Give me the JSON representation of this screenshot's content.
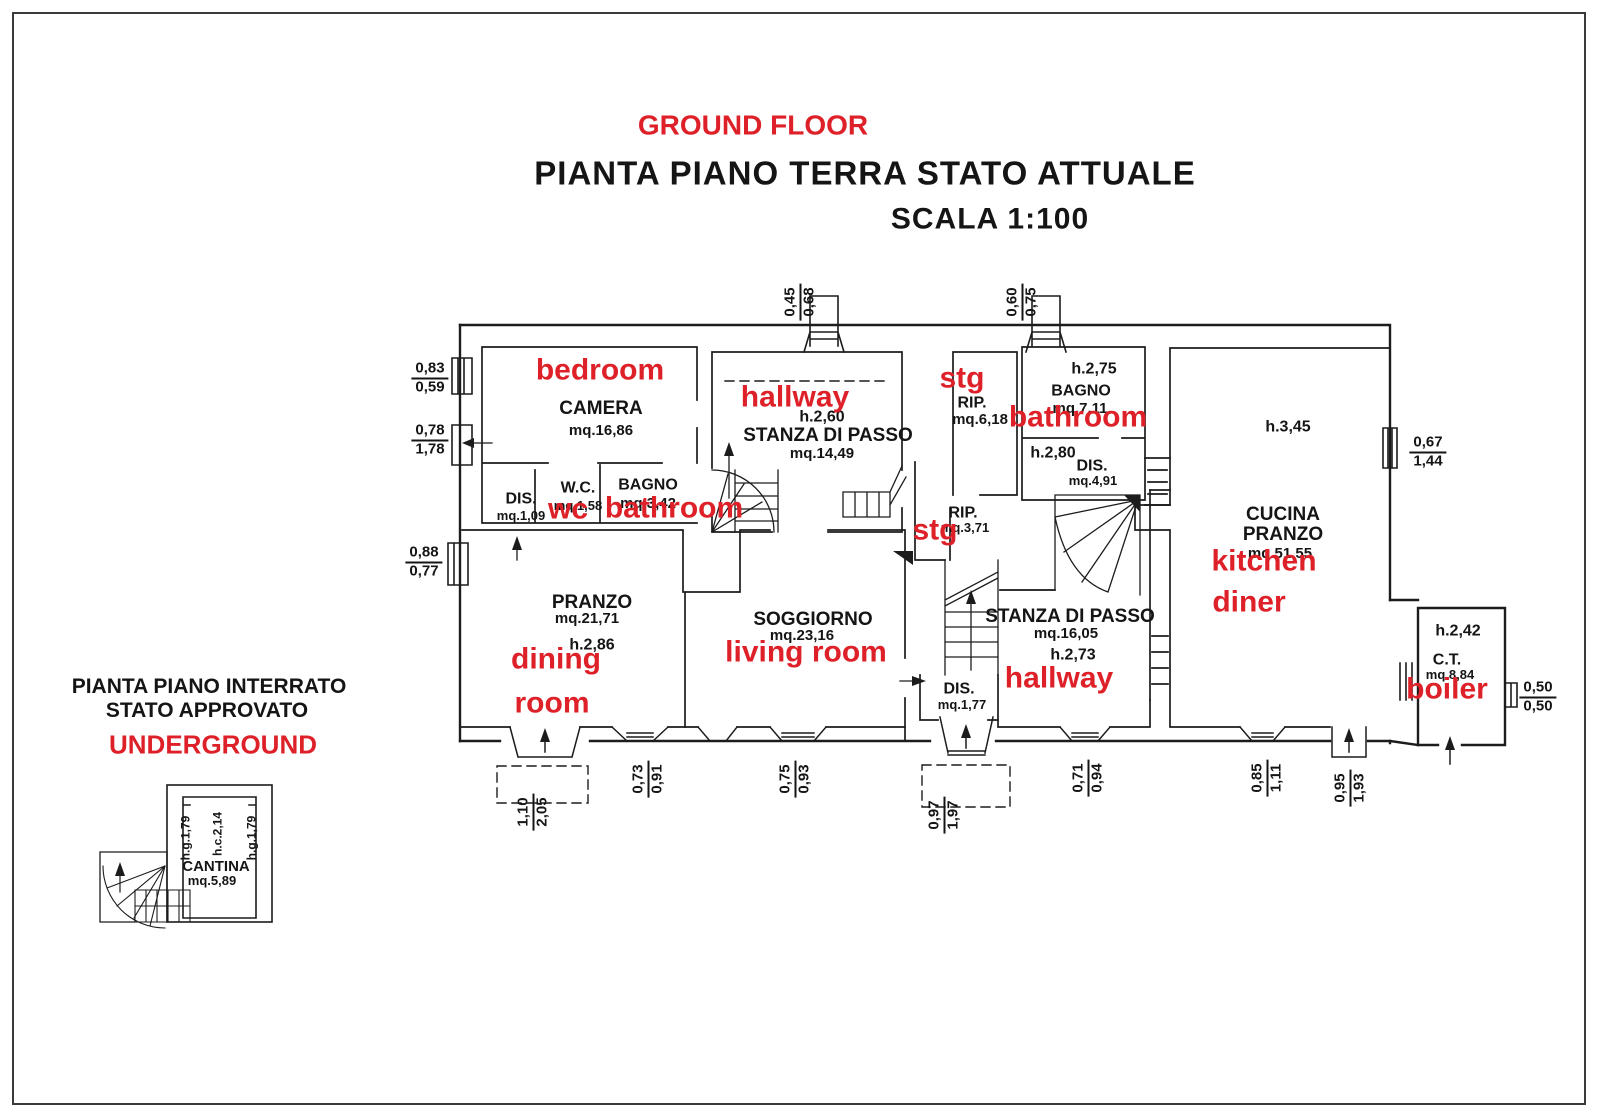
{
  "header": {
    "annotation": "GROUND FLOOR",
    "title": "PIANTA PIANO TERRA STATO ATTUALE",
    "scale": "SCALA 1:100"
  },
  "underground": {
    "title1": "PIANTA PIANO INTERRATO",
    "title2": "STATO APPROVATO",
    "annotation": "UNDERGROUND",
    "cantina": {
      "name": "CANTINA",
      "area": "mq.5,89"
    },
    "heights": {
      "left": "h.g.1,79",
      "center": "h.c.2,14",
      "right": "h.g.1,79"
    }
  },
  "rooms": {
    "camera": {
      "name": "CAMERA",
      "area": "mq.16,86"
    },
    "wc": {
      "name": "W.C.",
      "area": "mq.1,58"
    },
    "bagno1": {
      "name": "BAGNO",
      "area": "mq.3,42"
    },
    "dis1": {
      "name": "DIS.",
      "area": "mq.1,09"
    },
    "stanza1": {
      "name": "STANZA DI PASSO",
      "area": "mq.14,49",
      "height": "h.2,60"
    },
    "rip1": {
      "name": "RIP.",
      "area": "mq.6,18"
    },
    "bagno2": {
      "name": "BAGNO",
      "area": "mq.7,11",
      "height": "h.2,75"
    },
    "dis2": {
      "name": "DIS.",
      "area": "mq.4,91",
      "height": "h.2,80"
    },
    "rip2": {
      "name": "RIP.",
      "area": "mq.3,71"
    },
    "pranzo": {
      "name": "PRANZO",
      "area": "mq.21,71",
      "height": "h.2,86"
    },
    "soggiorno": {
      "name": "SOGGIORNO",
      "area": "mq.23,16"
    },
    "stanza2": {
      "name": "STANZA DI PASSO",
      "area": "mq.16,05",
      "height": "h.2,73"
    },
    "dis3": {
      "name": "DIS.",
      "area": "mq.1,77"
    },
    "cucina": {
      "name1": "CUCINA",
      "name2": "PRANZO",
      "area": "mq.51,55",
      "height": "h.3,45"
    },
    "ct": {
      "name": "C.T.",
      "area": "mq.8,84",
      "height": "h.2,42"
    }
  },
  "annotations": {
    "bedroom": "bedroom",
    "wc": "wc",
    "bathroom1": "bathroom",
    "hallway1": "hallway",
    "stg1": "stg",
    "bathroom2": "bathroom",
    "stg2": "stg",
    "dining1": "dining",
    "dining2": "room",
    "living": "living room",
    "hallway2": "hallway",
    "kitchen1": "kitchen",
    "kitchen2": "diner",
    "boiler": "boiler"
  },
  "dimensions": {
    "left1": {
      "a": "0,83",
      "b": "0,59"
    },
    "left2": {
      "a": "0,78",
      "b": "1,78"
    },
    "left3": {
      "a": "0,88",
      "b": "0,77"
    },
    "top1": {
      "a": "0,45",
      "b": "0,68"
    },
    "top2": {
      "a": "0,60",
      "b": "0,75"
    },
    "right1": {
      "a": "0,67",
      "b": "1,44"
    },
    "right2": {
      "a": "0,50",
      "b": "0,50"
    },
    "bottom1": {
      "a": "0,73",
      "b": "0,91"
    },
    "bottom2": {
      "a": "0,75",
      "b": "0,93"
    },
    "bottom3": {
      "a": "0,71",
      "b": "0,94"
    },
    "bottom4": {
      "a": "0,85",
      "b": "1,11"
    },
    "bottom5": {
      "a": "0,95",
      "b": "1,93"
    },
    "porch1": {
      "a": "1,10",
      "b": "2,05"
    },
    "porch2": {
      "a": "0,97",
      "b": "1,97"
    }
  },
  "colors": {
    "annotation_red": "#de2129",
    "line": "#1c1c1c",
    "background": "#ffffff"
  }
}
